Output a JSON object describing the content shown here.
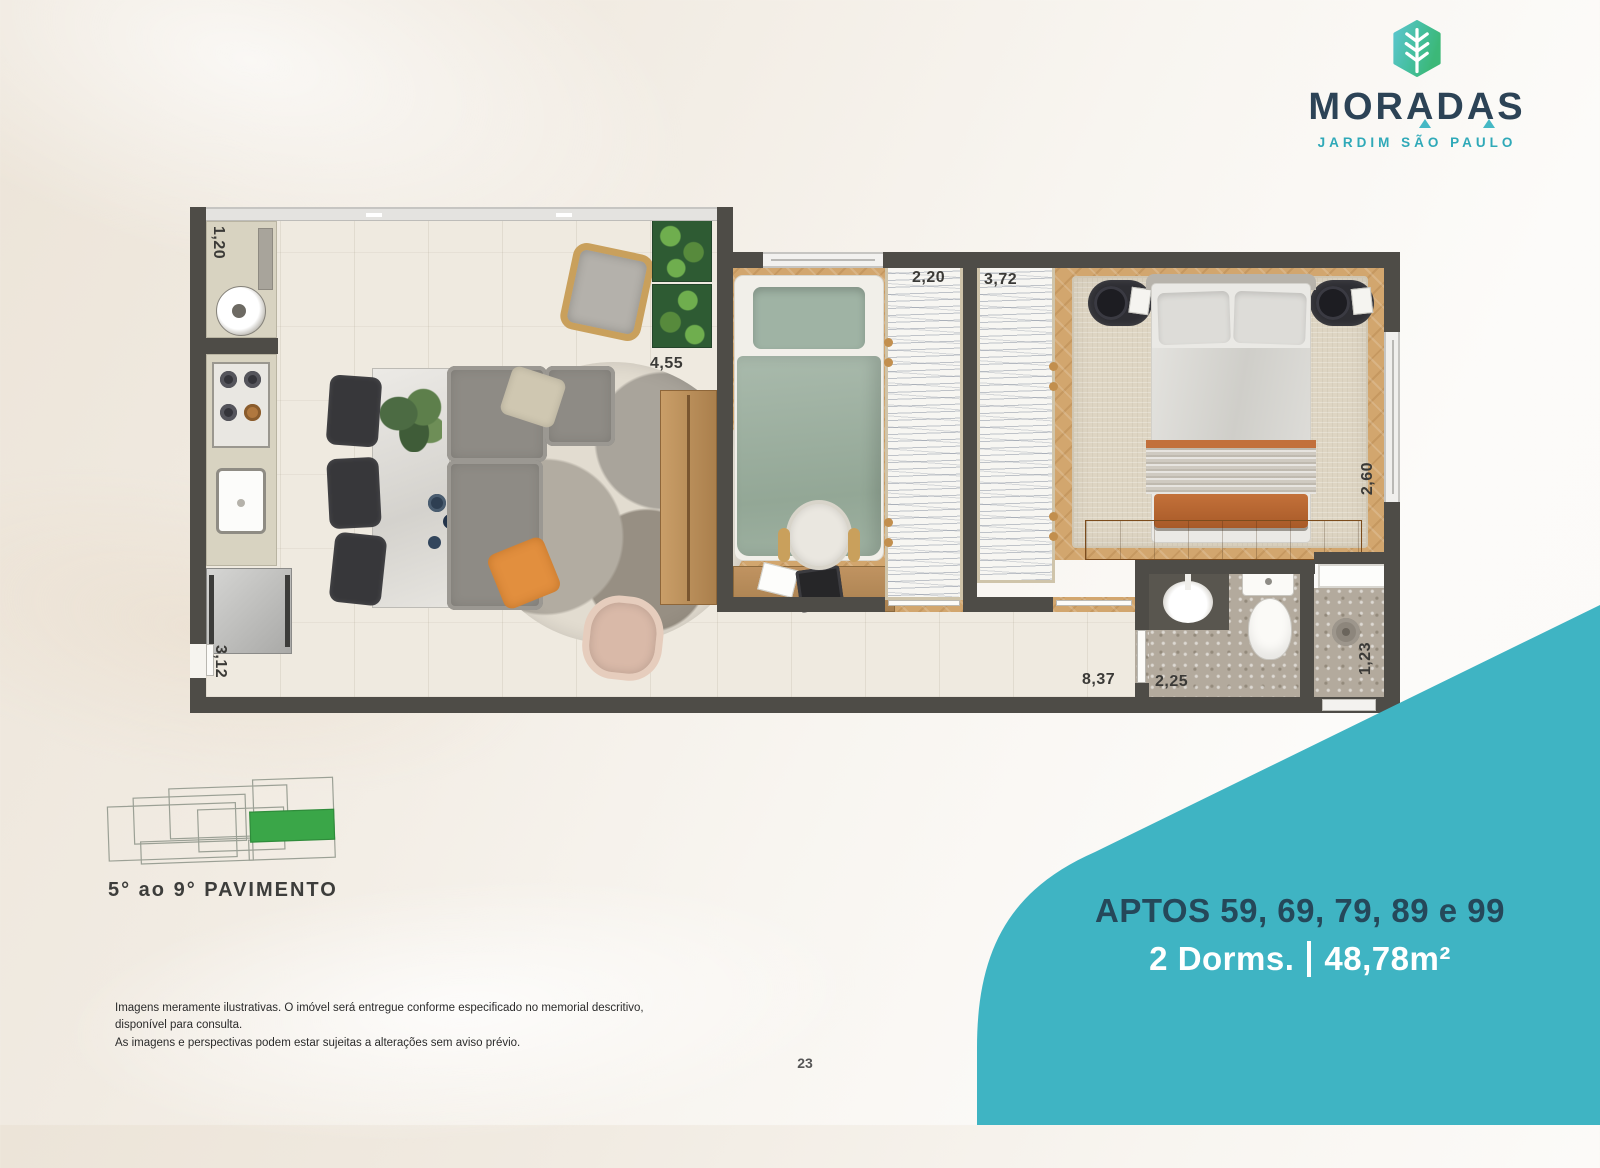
{
  "logo": {
    "brand": "MORADAS",
    "subtitle": "JARDIM SÃO PAULO",
    "icon": "leaf-hexagon-icon"
  },
  "unit": {
    "title": "APTOS 59, 69, 79, 89 e 99",
    "dorms": "2 Dorms.",
    "area": "48,78m²"
  },
  "keyplan": {
    "label": "5° ao 9° PAVIMENTO"
  },
  "plan": {
    "dims": {
      "service_width": "1,20",
      "entry_width": "3,12",
      "living_width": "4,55",
      "bedroom1_closet": "2,20",
      "bedroom2_closet": "3,72",
      "bedroom2_depth": "2,60",
      "hall_length": "8,37",
      "bathroom_width": "2,25",
      "shower_width": "1,23"
    }
  },
  "footer": {
    "disclaimer1": "Imagens meramente ilustrativas. O imóvel será entregue conforme especificado no memorial descritivo, disponível para consulta.",
    "disclaimer2": "As imagens e perspectivas podem estar sujeitas a alterações sem aviso prévio.",
    "page": "23"
  },
  "colors": {
    "teal": "#3FB4C3",
    "navy": "#27495C",
    "green": "#3AA648",
    "wall": "#4E4C47",
    "wood": "#D3A873"
  }
}
